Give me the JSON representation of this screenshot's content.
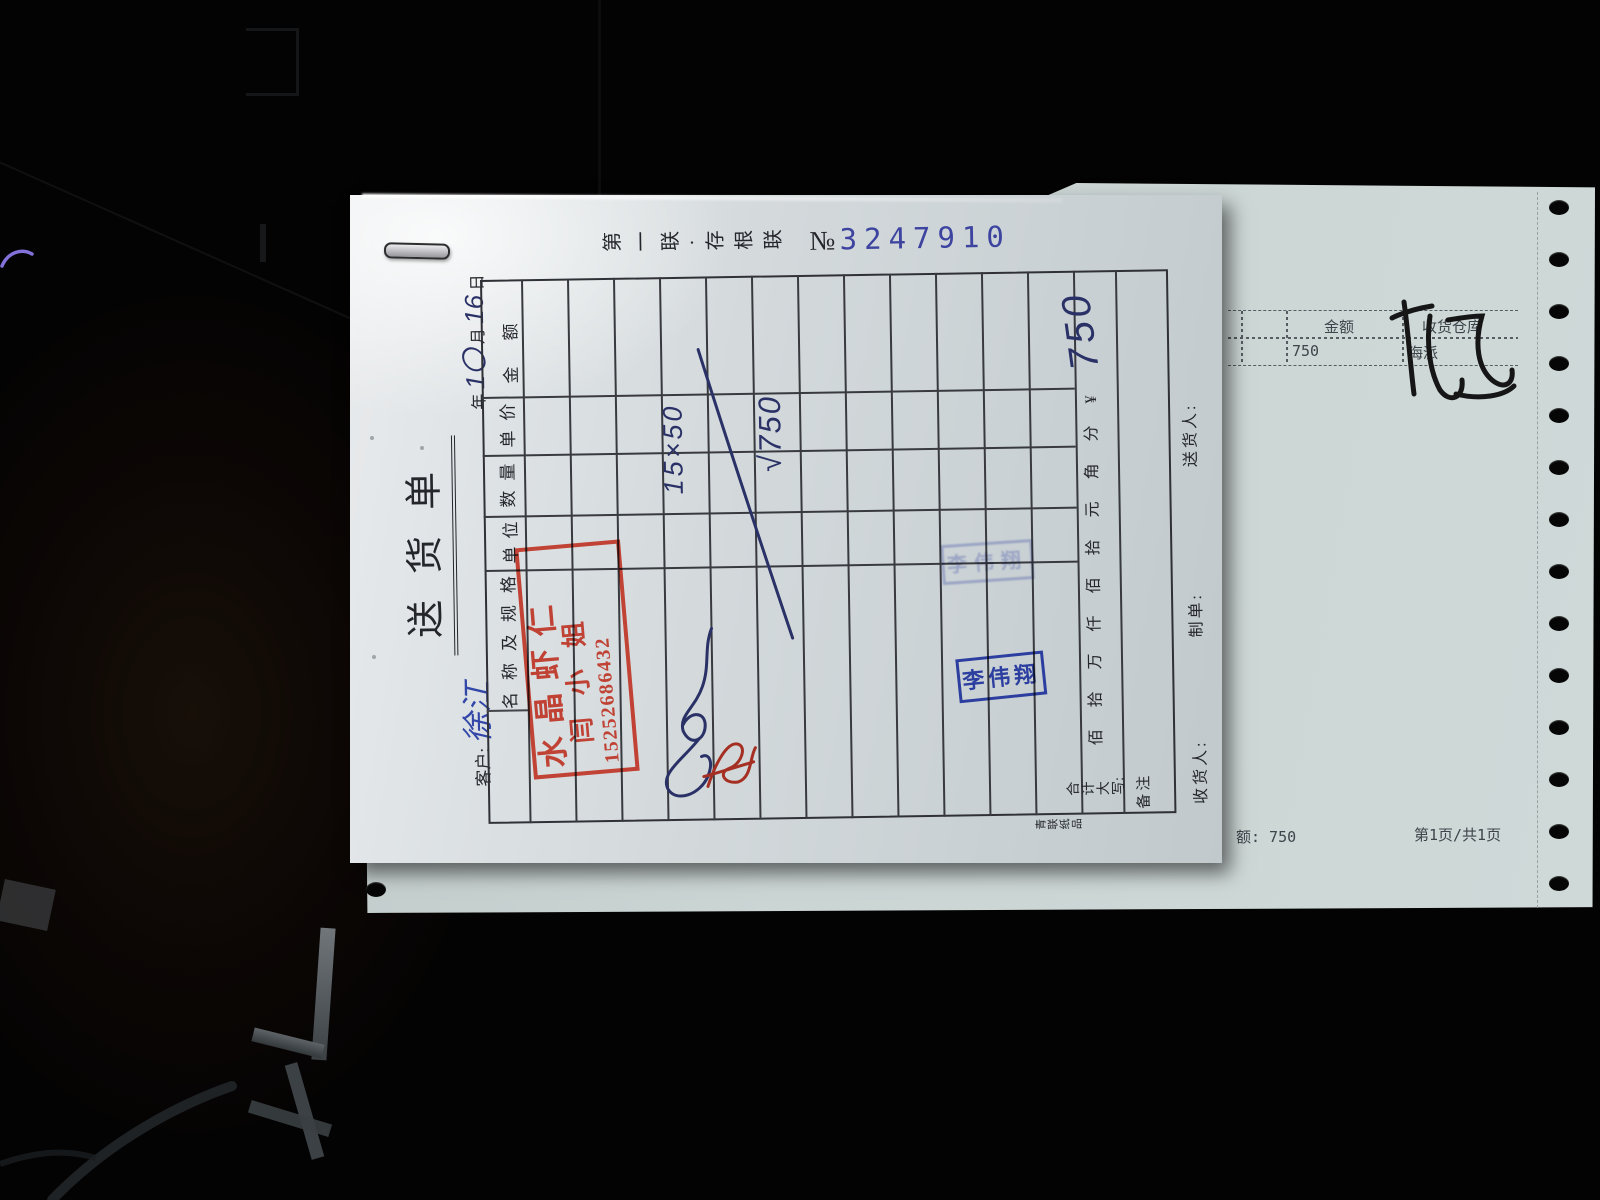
{
  "colors": {
    "red_stamp": "#bf392a",
    "blue_stamp": "#2c3e9f",
    "serial_digits": "#3d44a0",
    "handwriting_ink": "#2a3166",
    "print_black": "#24262b"
  },
  "top_sheet": {
    "copy_label": "第一联·存根联",
    "serial_prefix": "№",
    "serial_number": "3247910",
    "title": "送货单",
    "customer_label": "客户:",
    "customer_name": "徐江",
    "date": {
      "year_label": "年",
      "month_value": "1〇",
      "month_label": "月",
      "day_value": "16",
      "day_label": "日"
    },
    "table": {
      "col_header_name": "名称及规格",
      "col_header_unit": "单位",
      "col_header_qty": "数量",
      "col_header_price": "单价",
      "col_header_amount": "金额",
      "amount_units": "佰拾万仟佰拾元角分¥",
      "total_label": "合计\n大写:",
      "remark_label": "备注",
      "handwritten_calc": "15×50",
      "handwritten_result": "√750",
      "handwritten_total": "750"
    },
    "footer": {
      "receiver_label": "收货人:",
      "preparer_label": "制单:",
      "deliverer_label": "送货人:"
    },
    "printer_mark": "青联\n纸品",
    "red_stamp": {
      "line1": "水晶虾仁",
      "line2": "闫小姐",
      "phone": "15252686432"
    },
    "blue_stamp_name": "李伟翔",
    "faint_stamp_name": "李伟翔"
  },
  "under_sheet": {
    "table": {
      "col_amount": "金额",
      "col_warehouse": "收货仓库",
      "amount_value": "750",
      "warehouse_value": "海派"
    },
    "bottom_amount": "额: 750",
    "bottom_page": "第1页/共1页"
  }
}
